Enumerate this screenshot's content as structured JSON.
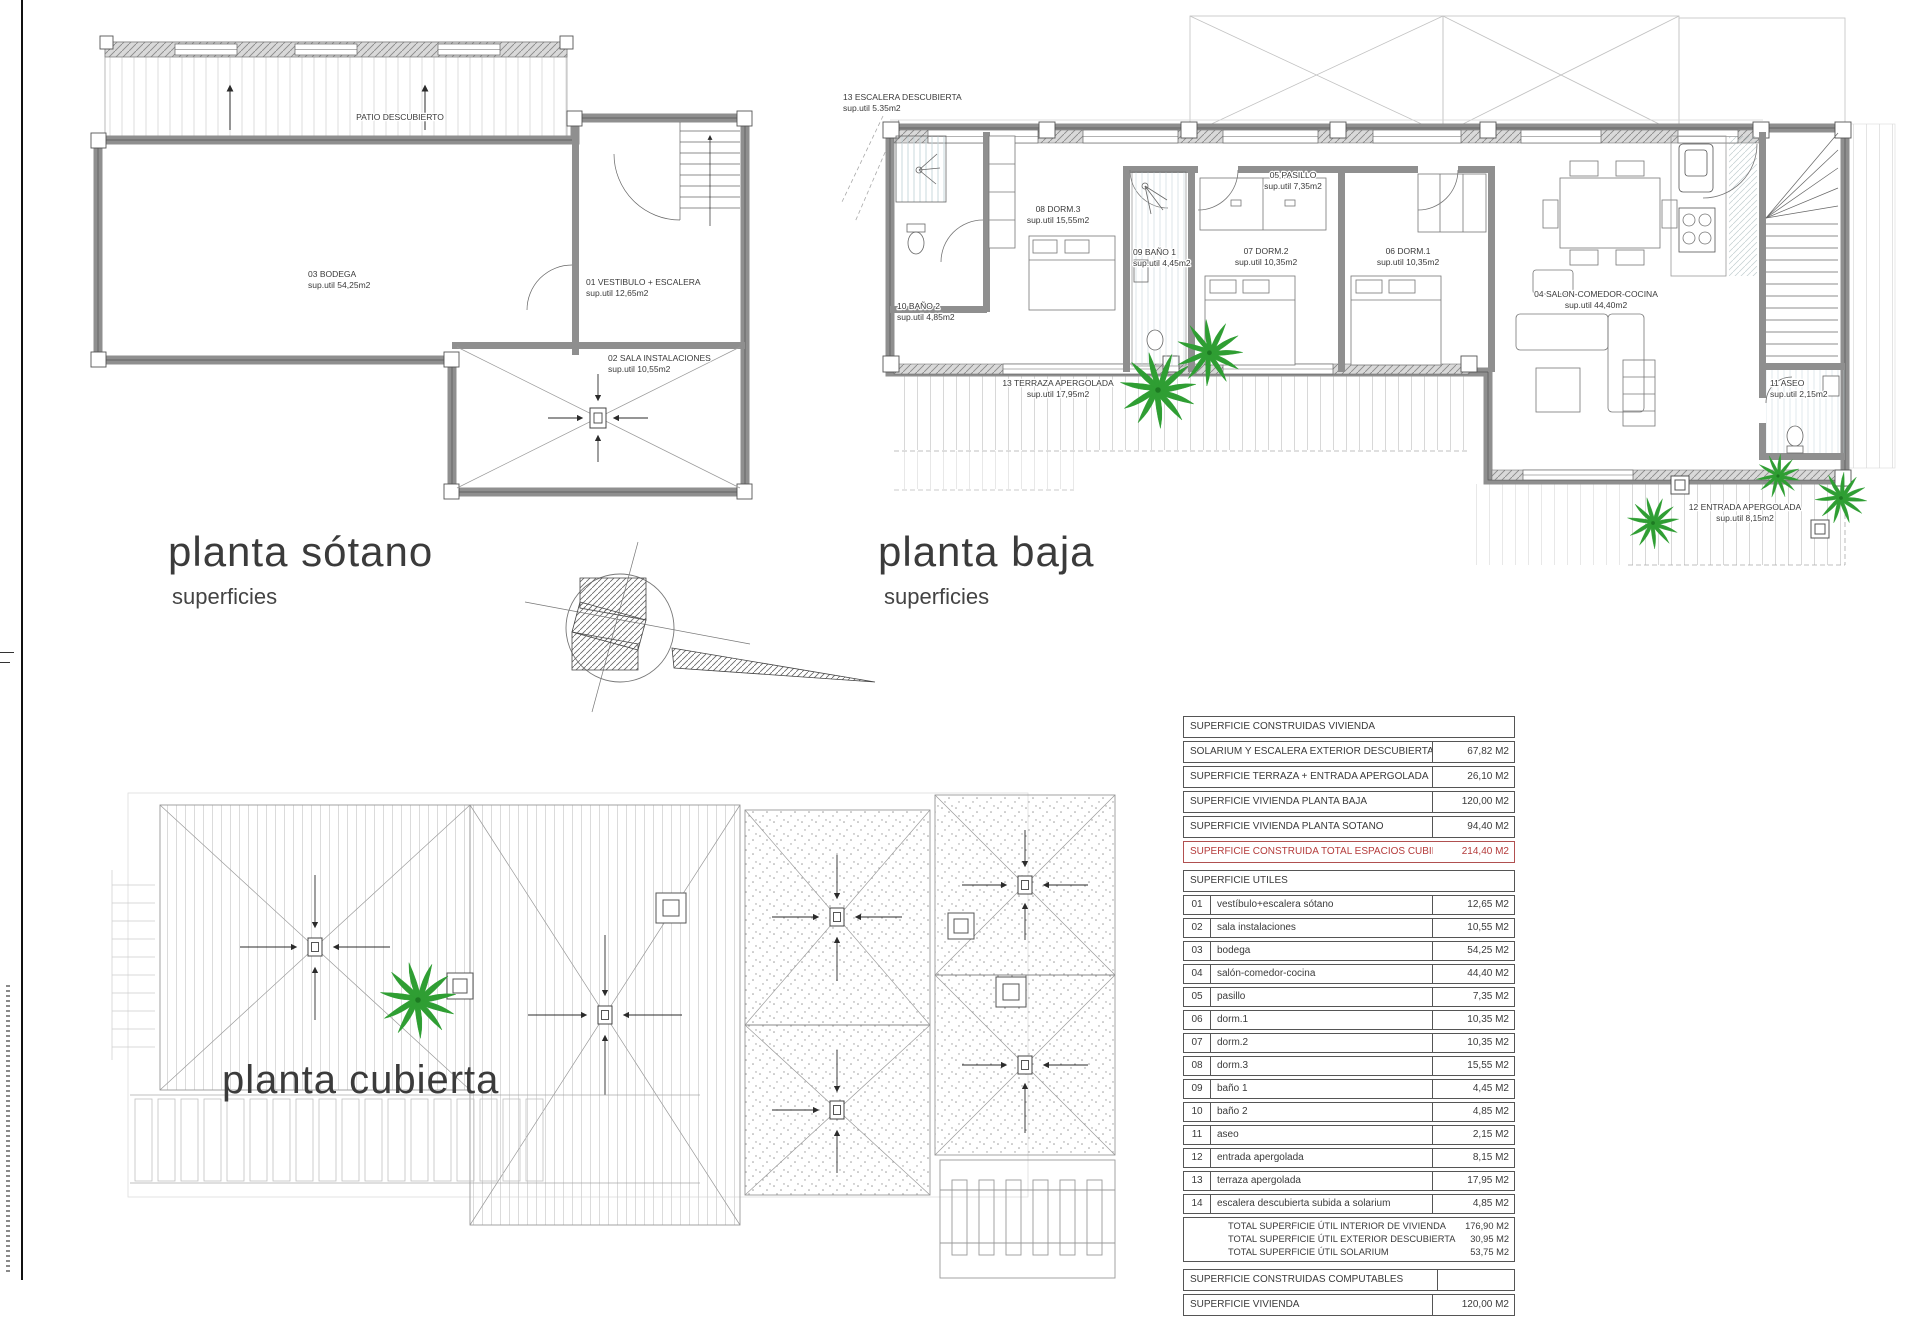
{
  "titles": {
    "sotano": {
      "title": "planta sótano",
      "subtitle": "superficies"
    },
    "baja": {
      "title": "planta baja",
      "subtitle": "superficies"
    },
    "cubierta": {
      "title": "planta cubierta"
    }
  },
  "sotano": {
    "patio_label": "PATIO DESCUBIERTO",
    "rooms": {
      "bodega": {
        "name": "03 BODEGA",
        "area": "sup.util 54,25m2"
      },
      "vestibulo": {
        "name": "01 VESTIBULO + ESCALERA",
        "area": "sup.util 12,65m2"
      },
      "sala": {
        "name": "02 SALA INSTALACIONES",
        "area": "sup.util 10,55m2"
      }
    }
  },
  "baja": {
    "rooms": {
      "escalera": {
        "name": "13 ESCALERA DESCUBIERTA",
        "area": "sup.util 5.35m2"
      },
      "pasillo": {
        "name": "05 PASILLO",
        "area": "sup.util 7,35m2"
      },
      "dorm3": {
        "name": "08 DORM.3",
        "area": "sup.util 15,55m2"
      },
      "bano1": {
        "name": "09 BAÑO 1",
        "area": "sup.util 4,45m2"
      },
      "dorm2": {
        "name": "07 DORM.2",
        "area": "sup.util 10,35m2"
      },
      "dorm1": {
        "name": "06 DORM.1",
        "area": "sup.util 10,35m2"
      },
      "salon": {
        "name": "04 SALON-COMEDOR-COCINA",
        "area": "sup.util 44,40m2"
      },
      "bano2": {
        "name": "10 BAÑO 2",
        "area": "sup.util 4,85m2"
      },
      "terraza": {
        "name": "13 TERRAZA APERGOLADA",
        "area": "sup.util 17,95m2"
      },
      "aseo": {
        "name": "11 ASEO",
        "area": "sup.util 2,15m2"
      },
      "entrada": {
        "name": "12 ENTRADA APERGOLADA",
        "area": "sup.util 8,15m2"
      }
    }
  },
  "tables": {
    "construidas": {
      "header": "SUPERFICIE CONSTRUIDAS VIVIENDA",
      "rows": [
        {
          "label": "SOLARIUM Y ESCALERA EXTERIOR DESCUBIERTA",
          "value": "67,82 M2"
        },
        {
          "label": "SUPERFICIE TERRAZA + ENTRADA APERGOLADA",
          "value": "26,10 M2"
        },
        {
          "label": "SUPERFICIE VIVIENDA PLANTA BAJA",
          "value": "120,00 M2"
        },
        {
          "label": "SUPERFICIE VIVIENDA PLANTA SOTANO",
          "value": "94,40 M2"
        }
      ],
      "total": {
        "label": "SUPERFICIE CONSTRUIDA TOTAL ESPACIOS CUBIERTOS",
        "value": "214,40 M2"
      }
    },
    "utiles": {
      "header": "SUPERFICIE UTILES",
      "rows": [
        {
          "num": "01",
          "label": "vestíbulo+escalera sótano",
          "value": "12,65 M2"
        },
        {
          "num": "02",
          "label": "sala instalaciones",
          "value": "10,55 M2"
        },
        {
          "num": "03",
          "label": "bodega",
          "value": "54,25 M2"
        },
        {
          "num": "04",
          "label": "salón-comedor-cocina",
          "value": "44,40 M2"
        },
        {
          "num": "05",
          "label": "pasillo",
          "value": "7,35 M2"
        },
        {
          "num": "06",
          "label": "dorm.1",
          "value": "10,35 M2"
        },
        {
          "num": "07",
          "label": "dorm.2",
          "value": "10,35 M2"
        },
        {
          "num": "08",
          "label": "dorm.3",
          "value": "15,55 M2"
        },
        {
          "num": "09",
          "label": "baño 1",
          "value": "4,45 M2"
        },
        {
          "num": "10",
          "label": "baño 2",
          "value": "4,85 M2"
        },
        {
          "num": "11",
          "label": "aseo",
          "value": "2,15 M2"
        },
        {
          "num": "12",
          "label": "entrada apergolada",
          "value": "8,15 M2"
        },
        {
          "num": "13",
          "label": "terraza apergolada",
          "value": "17,95 M2"
        },
        {
          "num": "14",
          "label": "escalera descubierta subida a solarium",
          "value": "4,85 M2"
        }
      ],
      "totals": [
        {
          "label": "TOTAL SUPERFICIE ÚTIL INTERIOR DE VIVIENDA",
          "value": "176,90 M2"
        },
        {
          "label": "TOTAL SUPERFICIE ÚTIL EXTERIOR DESCUBIERTA",
          "value": "30,95 M2"
        },
        {
          "label": "TOTAL SUPERFICIE ÚTIL SOLARIUM",
          "value": "53,75 M2"
        }
      ]
    },
    "computables": {
      "header": "SUPERFICIE CONSTRUIDAS COMPUTABLES",
      "rows": [
        {
          "label": "SUPERFICIE VIVIENDA",
          "value": "120,00 M2"
        }
      ]
    }
  }
}
